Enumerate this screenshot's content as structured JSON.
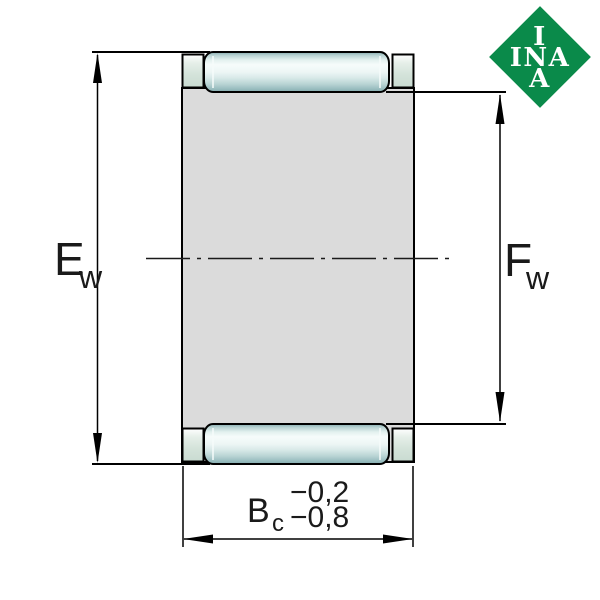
{
  "dimensions": {
    "ew": {
      "symbol": "E",
      "subscript": "w"
    },
    "fw": {
      "symbol": "F",
      "subscript": "w"
    },
    "bc": {
      "symbol": "B",
      "subscript": "c",
      "tolerance_upper": "−0,2",
      "tolerance_lower": "−0,8"
    }
  },
  "logo": {
    "lines": [
      "I",
      "INA",
      "A"
    ],
    "background_color": "#0a8a4a",
    "text_color": "#ffffff"
  },
  "colors": {
    "background": "#ffffff",
    "outline": "#000000",
    "body_fill": "#dbdbdb",
    "roller_highlight": "#f6fcfb",
    "roller_shadow": "#84a9ac",
    "cage_rim_fill": "#d4e3da",
    "centerline": "#1a1a1a"
  }
}
